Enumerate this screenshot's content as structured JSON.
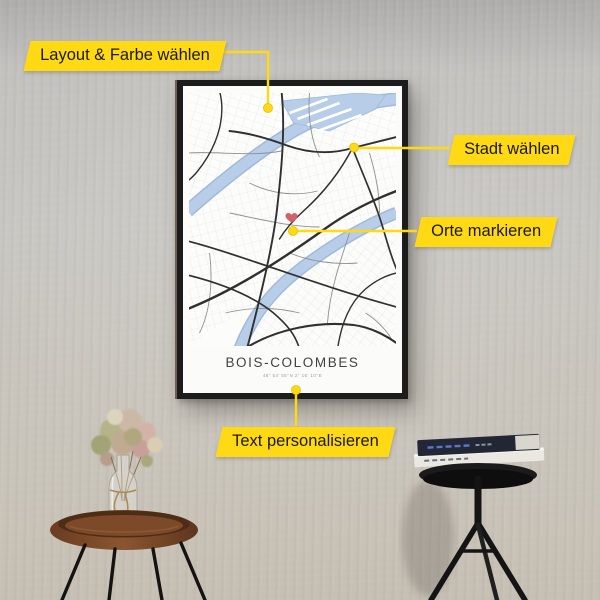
{
  "callouts": {
    "layout_color": {
      "label": "Layout & Farbe wählen"
    },
    "city": {
      "label": "Stadt wählen"
    },
    "places": {
      "label": "Orte markieren"
    },
    "personalize": {
      "label": "Text personalisieren"
    }
  },
  "poster": {
    "title": "BOIS-COLOMBES",
    "subtitle": "48° 54' 55''N  2° 16' 10''E"
  },
  "icons": {
    "heart_marker": "♥"
  },
  "colors": {
    "accent_yellow": "#FFD914",
    "river_blue": "#B7CDE8",
    "heart_red": "#D4606A",
    "frame_black": "#1C1C1C",
    "wall_gray": "#C7C5C1",
    "wood_brown": "#7A4928"
  }
}
